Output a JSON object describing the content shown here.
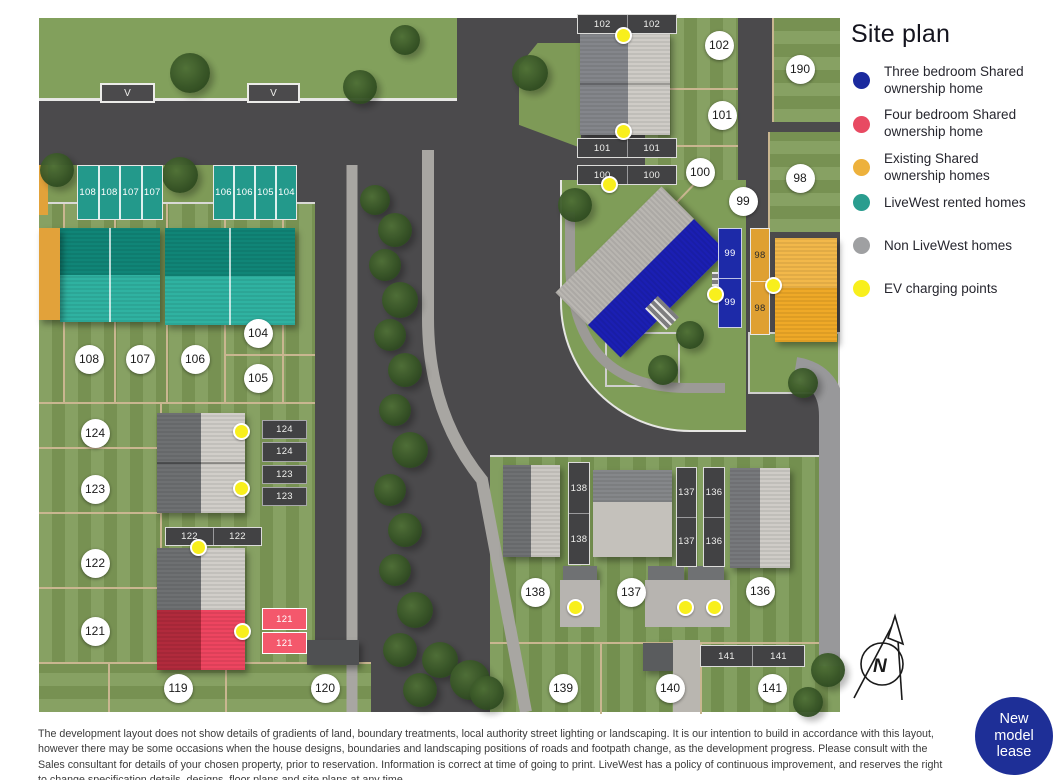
{
  "legend": {
    "title": "Site plan",
    "items": [
      {
        "label": "Three bedroom Shared ownership home",
        "color": "#1b2a9e",
        "lines": 2
      },
      {
        "label": "Four bedroom Shared ownership home",
        "color": "#e84a62",
        "lines": 2
      },
      {
        "label": "Existing Shared ownership homes",
        "color": "#edb13c",
        "lines": 2
      },
      {
        "label": "LiveWest rented homes",
        "color": "#2a9d8f",
        "lines": 1
      },
      {
        "label": "Non LiveWest homes",
        "color": "#9fa0a2",
        "lines": 1
      },
      {
        "label": "EV charging points",
        "color": "#f8ef1d",
        "lines": 1
      }
    ]
  },
  "map": {
    "visitor_bays": [
      {
        "label": "V",
        "x": 61,
        "y": 65,
        "w": 55,
        "h": 20
      },
      {
        "label": "V",
        "x": 208,
        "y": 65,
        "w": 53,
        "h": 20
      }
    ],
    "parking_strips": [
      {
        "cells": [
          "102",
          "102"
        ],
        "x": 538,
        "y": -4,
        "w": 100,
        "h": 20,
        "dir": "h",
        "style": "dark"
      },
      {
        "cells": [
          "101",
          "101"
        ],
        "x": 538,
        "y": 120,
        "w": 100,
        "h": 20,
        "dir": "h",
        "style": "dark"
      },
      {
        "cells": [
          "100",
          "100"
        ],
        "x": 538,
        "y": 147,
        "w": 100,
        "h": 20,
        "dir": "h",
        "style": "dark"
      },
      {
        "cells": [
          "108",
          "108",
          "107",
          "107"
        ],
        "x": 38,
        "y": 147,
        "w": 86,
        "h": 55,
        "dir": "h",
        "style": "teal"
      },
      {
        "cells": [
          "106",
          "106",
          "105",
          "104"
        ],
        "x": 174,
        "y": 147,
        "w": 84,
        "h": 55,
        "dir": "h",
        "style": "teal"
      },
      {
        "cells": [
          "124",
          "124",
          "123",
          "123"
        ],
        "x": 223,
        "y": 402,
        "w": 45,
        "h": 86,
        "dir": "v",
        "style": "dark-gap"
      },
      {
        "cells": [
          "122",
          "122"
        ],
        "x": 126,
        "y": 509,
        "w": 97,
        "h": 19,
        "dir": "h",
        "style": "dark"
      },
      {
        "cells": [
          "121",
          "121"
        ],
        "x": 223,
        "y": 590,
        "w": 45,
        "h": 46,
        "dir": "v",
        "style": "pink"
      },
      {
        "cells": [
          "138",
          "138"
        ],
        "x": 529,
        "y": 444,
        "w": 22,
        "h": 103,
        "dir": "v",
        "style": "dark"
      },
      {
        "cells": [
          "137",
          "137"
        ],
        "x": 637,
        "y": 449,
        "w": 21,
        "h": 100,
        "dir": "v",
        "style": "dark"
      },
      {
        "cells": [
          "136",
          "136"
        ],
        "x": 664,
        "y": 449,
        "w": 22,
        "h": 100,
        "dir": "v",
        "style": "dark"
      },
      {
        "cells": [
          "141",
          "141"
        ],
        "x": 661,
        "y": 627,
        "w": 105,
        "h": 22,
        "dir": "h",
        "style": "dark"
      },
      {
        "cells": [
          "99",
          "99"
        ],
        "x": 679,
        "y": 210,
        "w": 24,
        "h": 100,
        "dir": "v",
        "style": "blue"
      },
      {
        "cells": [
          "98",
          "98"
        ],
        "x": 711,
        "y": 210,
        "w": 20,
        "h": 107,
        "dir": "v",
        "style": "orange"
      }
    ],
    "plot_circles": [
      {
        "id": "102",
        "x": 680,
        "y": 27
      },
      {
        "id": "190",
        "x": 761,
        "y": 51
      },
      {
        "id": "101",
        "x": 683,
        "y": 97
      },
      {
        "id": "100",
        "x": 661,
        "y": 154
      },
      {
        "id": "98",
        "x": 761,
        "y": 160
      },
      {
        "id": "99",
        "x": 704,
        "y": 183
      },
      {
        "id": "104",
        "x": 219,
        "y": 315
      },
      {
        "id": "108",
        "x": 50,
        "y": 341
      },
      {
        "id": "107",
        "x": 101,
        "y": 341
      },
      {
        "id": "106",
        "x": 156,
        "y": 341
      },
      {
        "id": "105",
        "x": 219,
        "y": 360
      },
      {
        "id": "124",
        "x": 56,
        "y": 415
      },
      {
        "id": "123",
        "x": 56,
        "y": 471
      },
      {
        "id": "122",
        "x": 56,
        "y": 545
      },
      {
        "id": "121",
        "x": 56,
        "y": 613
      },
      {
        "id": "119",
        "x": 139,
        "y": 670
      },
      {
        "id": "120",
        "x": 286,
        "y": 670
      },
      {
        "id": "138",
        "x": 496,
        "y": 574
      },
      {
        "id": "137",
        "x": 592,
        "y": 574
      },
      {
        "id": "136",
        "x": 721,
        "y": 573
      },
      {
        "id": "139",
        "x": 524,
        "y": 670
      },
      {
        "id": "140",
        "x": 631,
        "y": 670
      },
      {
        "id": "141",
        "x": 733,
        "y": 670
      }
    ],
    "ev_charging_points": [
      {
        "x": 586,
        "y": 19
      },
      {
        "x": 586,
        "y": 115
      },
      {
        "x": 572,
        "y": 168
      },
      {
        "x": 678,
        "y": 278
      },
      {
        "x": 736,
        "y": 269
      },
      {
        "x": 204,
        "y": 415
      },
      {
        "x": 204,
        "y": 472
      },
      {
        "x": 161,
        "y": 531
      },
      {
        "x": 205,
        "y": 615
      },
      {
        "x": 538,
        "y": 591
      },
      {
        "x": 648,
        "y": 591
      },
      {
        "x": 677,
        "y": 591
      }
    ]
  },
  "north": {
    "label": "N"
  },
  "badge": {
    "lines": [
      "New",
      "model",
      "lease"
    ],
    "color": "#1e2f97"
  },
  "disclaimer": "The development layout does not show details of gradients of land, boundary treatments, local authority street lighting or landscaping. It is our intention to build in accordance with this layout, however there may be some occasions when the house designs, boundaries and landscaping positions of roads and footpath change, as the development progress. Please consult with the Sales consultant for details of your chosen property, prior to reservation. Information is correct at time of going to print. LiveWest has a policy of continuous improvement, and reserves the right to change specification details, designs, floor plans and site plans at any time."
}
